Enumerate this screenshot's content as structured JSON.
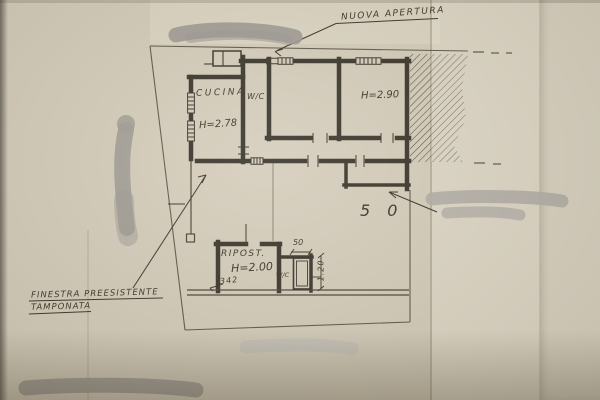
{
  "colors": {
    "paper": "#d5cdbb",
    "paper_right": "#ded7c6",
    "ink": "#3a3428",
    "redaction_grey": "#a29e96"
  },
  "plan": {
    "annotations": {
      "nuova_apertura": "NUOVA APERTURA",
      "finestra_line1": "FINESTRA PREESISTENTE",
      "finestra_line2": "TAMPONATA"
    },
    "rooms": {
      "cucina": {
        "label": "CUCINA",
        "height": "H=2.78"
      },
      "wc": {
        "label": "W/C"
      },
      "stanza_destra": {
        "height": "H=2.90"
      },
      "ripostiglio": {
        "label": "RIPOST.",
        "height": "H=2.00"
      },
      "wc_piccolo": {
        "label": "W/C"
      }
    },
    "dimensions": {
      "nota_50_grande": "5 0",
      "larghezza_50": "50",
      "larghezza_342": "342",
      "altezza_120": "1.20"
    }
  }
}
